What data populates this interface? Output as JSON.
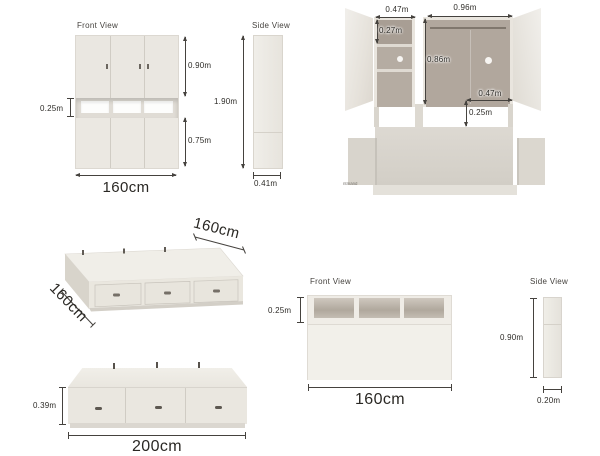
{
  "page": {
    "background": "#ffffff"
  },
  "colors": {
    "furniture_light": "#eae7e1",
    "furniture_interior": "#b3aaa0",
    "dimension_line": "#45423e",
    "label_text": "#2d2b27"
  },
  "figures": {
    "wardrobe_front": {
      "title": "Front View",
      "dim_upper_height": "0.90m",
      "dim_niche_height": "0.25m",
      "dim_lower_height": "0.75m",
      "dim_width": "160cm"
    },
    "wardrobe_side": {
      "title": "Side View",
      "dim_height": "1.90m",
      "dim_depth": "0.41m"
    },
    "wardrobe_open": {
      "dim_left_width": "0.47m",
      "dim_right_width": "0.96m",
      "dim_top_shelf_height": "0.27m",
      "dim_interior_height": "0.86m",
      "dim_niche_width": "0.47m",
      "dim_niche_height": "0.25m",
      "watermark": "ntmand"
    },
    "bed_isometric": {
      "dim_length": "160cm",
      "dim_width": "160cm"
    },
    "bed_front": {
      "dim_height": "0.39m",
      "dim_width": "200cm"
    },
    "headboard_front": {
      "title": "Front View",
      "dim_shelf_height": "0.25m",
      "dim_width": "160cm"
    },
    "headboard_side": {
      "title": "Side View",
      "dim_height": "0.90m",
      "dim_depth": "0.20m"
    }
  }
}
